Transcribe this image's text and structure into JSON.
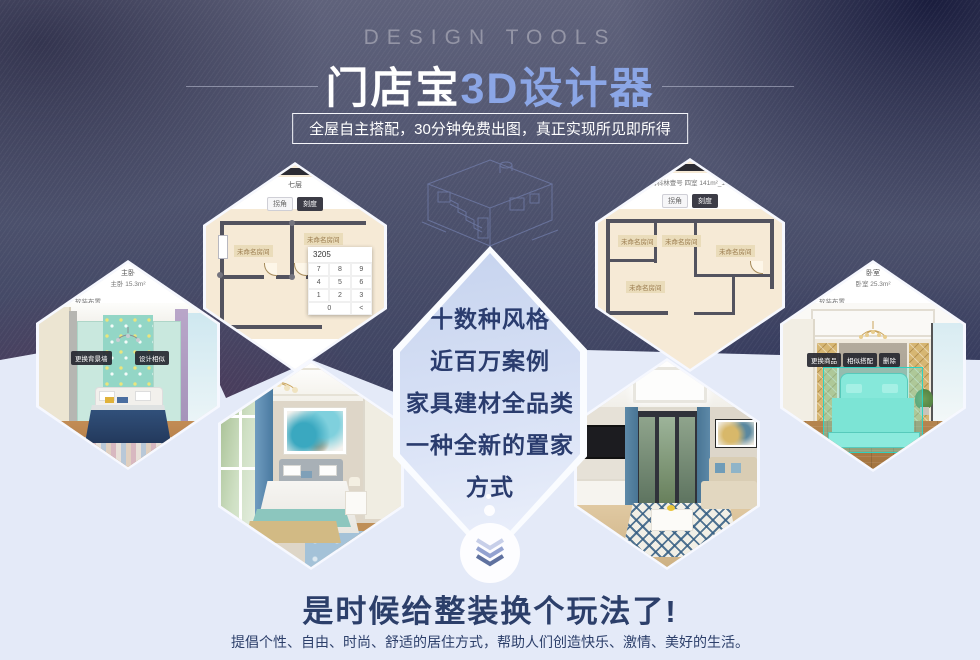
{
  "header": {
    "kicker": "DESIGN TOOLS",
    "title_white": "门店宝",
    "title_blue": "3D设计器",
    "subtitle": "全屋自主搭配，30分钟免费出图，真正实现所见即所得"
  },
  "center_hex": {
    "lines": [
      "十数种风格",
      "近百万案例",
      "家具建材全品类",
      "一种全新的置家方式"
    ]
  },
  "floorplan_left": {
    "title": "七层",
    "toggle_left": "拐角",
    "toggle_right": "刻度",
    "rooms": [
      "未命名房间",
      "未命名房间"
    ],
    "keypad": {
      "value": "3205",
      "keys": [
        "7",
        "8",
        "9",
        "4",
        "5",
        "6",
        "1",
        "2",
        "3",
        "0",
        "<"
      ]
    }
  },
  "floorplan_right": {
    "caption": "成都 卡德姆科林壹号 四室 141m²_1493084698",
    "toggle_left": "拐角",
    "toggle_right": "刻度",
    "room_labels": [
      "未命名房间",
      "未命名房间",
      "未命名房间",
      "未命名房间"
    ]
  },
  "bedroom_left": {
    "title": "主卧",
    "area": "主卧 15.3m²",
    "tabs": [
      "硬装设计",
      "软装布置"
    ],
    "buttons": [
      "更换背景墙",
      "设计相似"
    ]
  },
  "bedroom_right": {
    "title": "卧室",
    "area": "卧室 25.3m²",
    "tabs": [
      "硬装设计",
      "软装布置"
    ],
    "buttons": [
      "更换商品",
      "相似搭配",
      "删除"
    ]
  },
  "footer": {
    "headline": "是时候给整装换个玩法了!",
    "subline": "提倡个性、自由、时尚、舒适的居住方式，帮助人们创造快乐、激情、美好的生活。"
  },
  "colors": {
    "accent_blue": "#8ba6e6",
    "navy_text": "#2c3f6a",
    "selection_teal": "#2ed2c2",
    "dark_bg": "#3a3f5e",
    "light_bg": "#e4eaf8"
  }
}
